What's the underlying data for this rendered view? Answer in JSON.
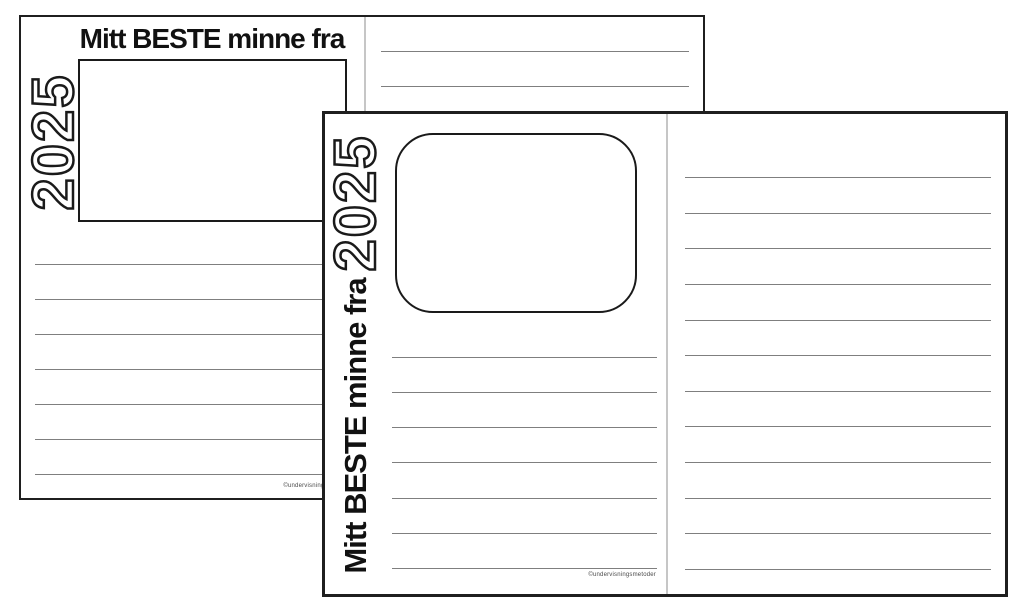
{
  "canvas": {
    "width": 1024,
    "height": 614,
    "background": "#ffffff"
  },
  "colors": {
    "page_background": "#ffffff",
    "page_border": "#1f1f1f",
    "rule_line": "#7f7f7f",
    "column_divider": "#c6c6c6",
    "ink": "#111111",
    "year_outline": "#1a1a1a",
    "year_fill": "#ffffff"
  },
  "back_page": {
    "title": "Mitt BESTE minne fra",
    "year": "2025",
    "credit": "©undervisningsmetoder",
    "left_line_count": 7,
    "right_line_count": 2
  },
  "front_page": {
    "vertical_title": "Mitt BESTE minne fra",
    "year": "2025",
    "credit": "©undervisningsmetoder",
    "left_line_count": 7,
    "right_line_count": 12
  }
}
